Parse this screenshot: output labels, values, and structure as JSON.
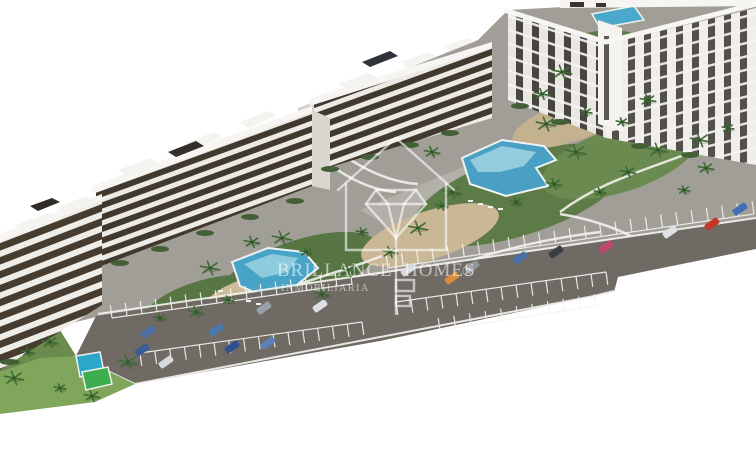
{
  "watermark": {
    "brand_word_left": "BRILLANCE",
    "brand_word_right": "HOMES",
    "registered_symbol": "®",
    "tagline": "INMOBILIARIA",
    "logo": "house-diamond-key-icon",
    "text_color": "#ffffff"
  },
  "palette": {
    "background": "#ffffff",
    "site_ground": "#a19e98",
    "plaza_light": "#b3b0aa",
    "road": "#6f6a63",
    "road_markings": "#f5f4f0",
    "building_light": "#efede9",
    "building_slab": "#eceae5",
    "building_window_dark": "#41382e",
    "garden_green": "#5d7b47",
    "lawn_green": "#7fa65a",
    "sport_court_green": "#3dae4e",
    "sand_path": "#c9b795",
    "pool_blue": "#4aa0c4",
    "pool_light_blue": "#9fd4e2"
  },
  "scene": {
    "cars": [
      {
        "x": 148,
        "y": 332,
        "color": "#4f6fa5"
      },
      {
        "x": 142,
        "y": 350,
        "color": "#3c5c96"
      },
      {
        "x": 166,
        "y": 362,
        "color": "#d6dadd"
      },
      {
        "x": 216,
        "y": 330,
        "color": "#4a79b0"
      },
      {
        "x": 232,
        "y": 347,
        "color": "#2f4f8f"
      },
      {
        "x": 264,
        "y": 308,
        "color": "#9aa2a8"
      },
      {
        "x": 268,
        "y": 343,
        "color": "#5b80b5"
      },
      {
        "x": 320,
        "y": 306,
        "color": "#dde1e4"
      },
      {
        "x": 408,
        "y": 270,
        "color": "#d5dade"
      },
      {
        "x": 452,
        "y": 278,
        "color": "#d98b3a"
      },
      {
        "x": 472,
        "y": 267,
        "color": "#8f979e"
      },
      {
        "x": 520,
        "y": 258,
        "color": "#4a6fa8"
      },
      {
        "x": 556,
        "y": 252,
        "color": "#3a3f46"
      },
      {
        "x": 606,
        "y": 247,
        "color": "#c04a6e"
      },
      {
        "x": 670,
        "y": 232,
        "color": "#dfe3e6"
      },
      {
        "x": 712,
        "y": 224,
        "color": "#c0392b"
      },
      {
        "x": 740,
        "y": 209,
        "color": "#3f6fb5"
      }
    ],
    "palms": [
      {
        "x": 28,
        "y": 352
      },
      {
        "x": 50,
        "y": 342
      },
      {
        "x": 14,
        "y": 378
      },
      {
        "x": 60,
        "y": 388
      },
      {
        "x": 92,
        "y": 396
      },
      {
        "x": 128,
        "y": 362
      },
      {
        "x": 160,
        "y": 318
      },
      {
        "x": 196,
        "y": 312
      },
      {
        "x": 210,
        "y": 268
      },
      {
        "x": 228,
        "y": 300
      },
      {
        "x": 252,
        "y": 242
      },
      {
        "x": 282,
        "y": 238
      },
      {
        "x": 306,
        "y": 252
      },
      {
        "x": 322,
        "y": 294
      },
      {
        "x": 348,
        "y": 270
      },
      {
        "x": 362,
        "y": 232
      },
      {
        "x": 390,
        "y": 252
      },
      {
        "x": 418,
        "y": 228
      },
      {
        "x": 442,
        "y": 206
      },
      {
        "x": 432,
        "y": 152
      },
      {
        "x": 452,
        "y": 192
      },
      {
        "x": 516,
        "y": 202
      },
      {
        "x": 554,
        "y": 184
      },
      {
        "x": 576,
        "y": 152
      },
      {
        "x": 600,
        "y": 192
      },
      {
        "x": 628,
        "y": 172
      },
      {
        "x": 658,
        "y": 150
      },
      {
        "x": 684,
        "y": 190
      },
      {
        "x": 706,
        "y": 168
      },
      {
        "x": 546,
        "y": 124
      },
      {
        "x": 586,
        "y": 112
      },
      {
        "x": 542,
        "y": 94
      },
      {
        "x": 562,
        "y": 72
      },
      {
        "x": 622,
        "y": 122
      },
      {
        "x": 648,
        "y": 100
      },
      {
        "x": 700,
        "y": 140
      },
      {
        "x": 728,
        "y": 128
      }
    ],
    "parking_rows": [
      {
        "x1": 112,
        "y1": 318,
        "x2": 352,
        "y2": 284,
        "n": 16,
        "len": 13,
        "dir": -1
      },
      {
        "x1": 388,
        "y1": 268,
        "x2": 754,
        "y2": 214,
        "n": 24,
        "len": 13,
        "dir": -1
      },
      {
        "x1": 140,
        "y1": 353,
        "x2": 362,
        "y2": 322,
        "n": 15,
        "len": 13,
        "dir": 1
      },
      {
        "x1": 396,
        "y1": 302,
        "x2": 606,
        "y2": 272,
        "n": 14,
        "len": 13,
        "dir": 1
      },
      {
        "x1": 440,
        "y1": 330,
        "x2": 596,
        "y2": 306,
        "n": 10,
        "len": 12,
        "dir": -1
      }
    ],
    "road_edge_lines": [
      {
        "x1": 98,
        "y1": 314,
        "x2": 756,
        "y2": 218
      },
      {
        "x1": 135,
        "y1": 384,
        "x2": 594,
        "y2": 296
      },
      {
        "x1": 594,
        "y1": 296,
        "x2": 614,
        "y2": 291
      },
      {
        "x1": 76,
        "y1": 356,
        "x2": 135,
        "y2": 384
      }
    ]
  }
}
